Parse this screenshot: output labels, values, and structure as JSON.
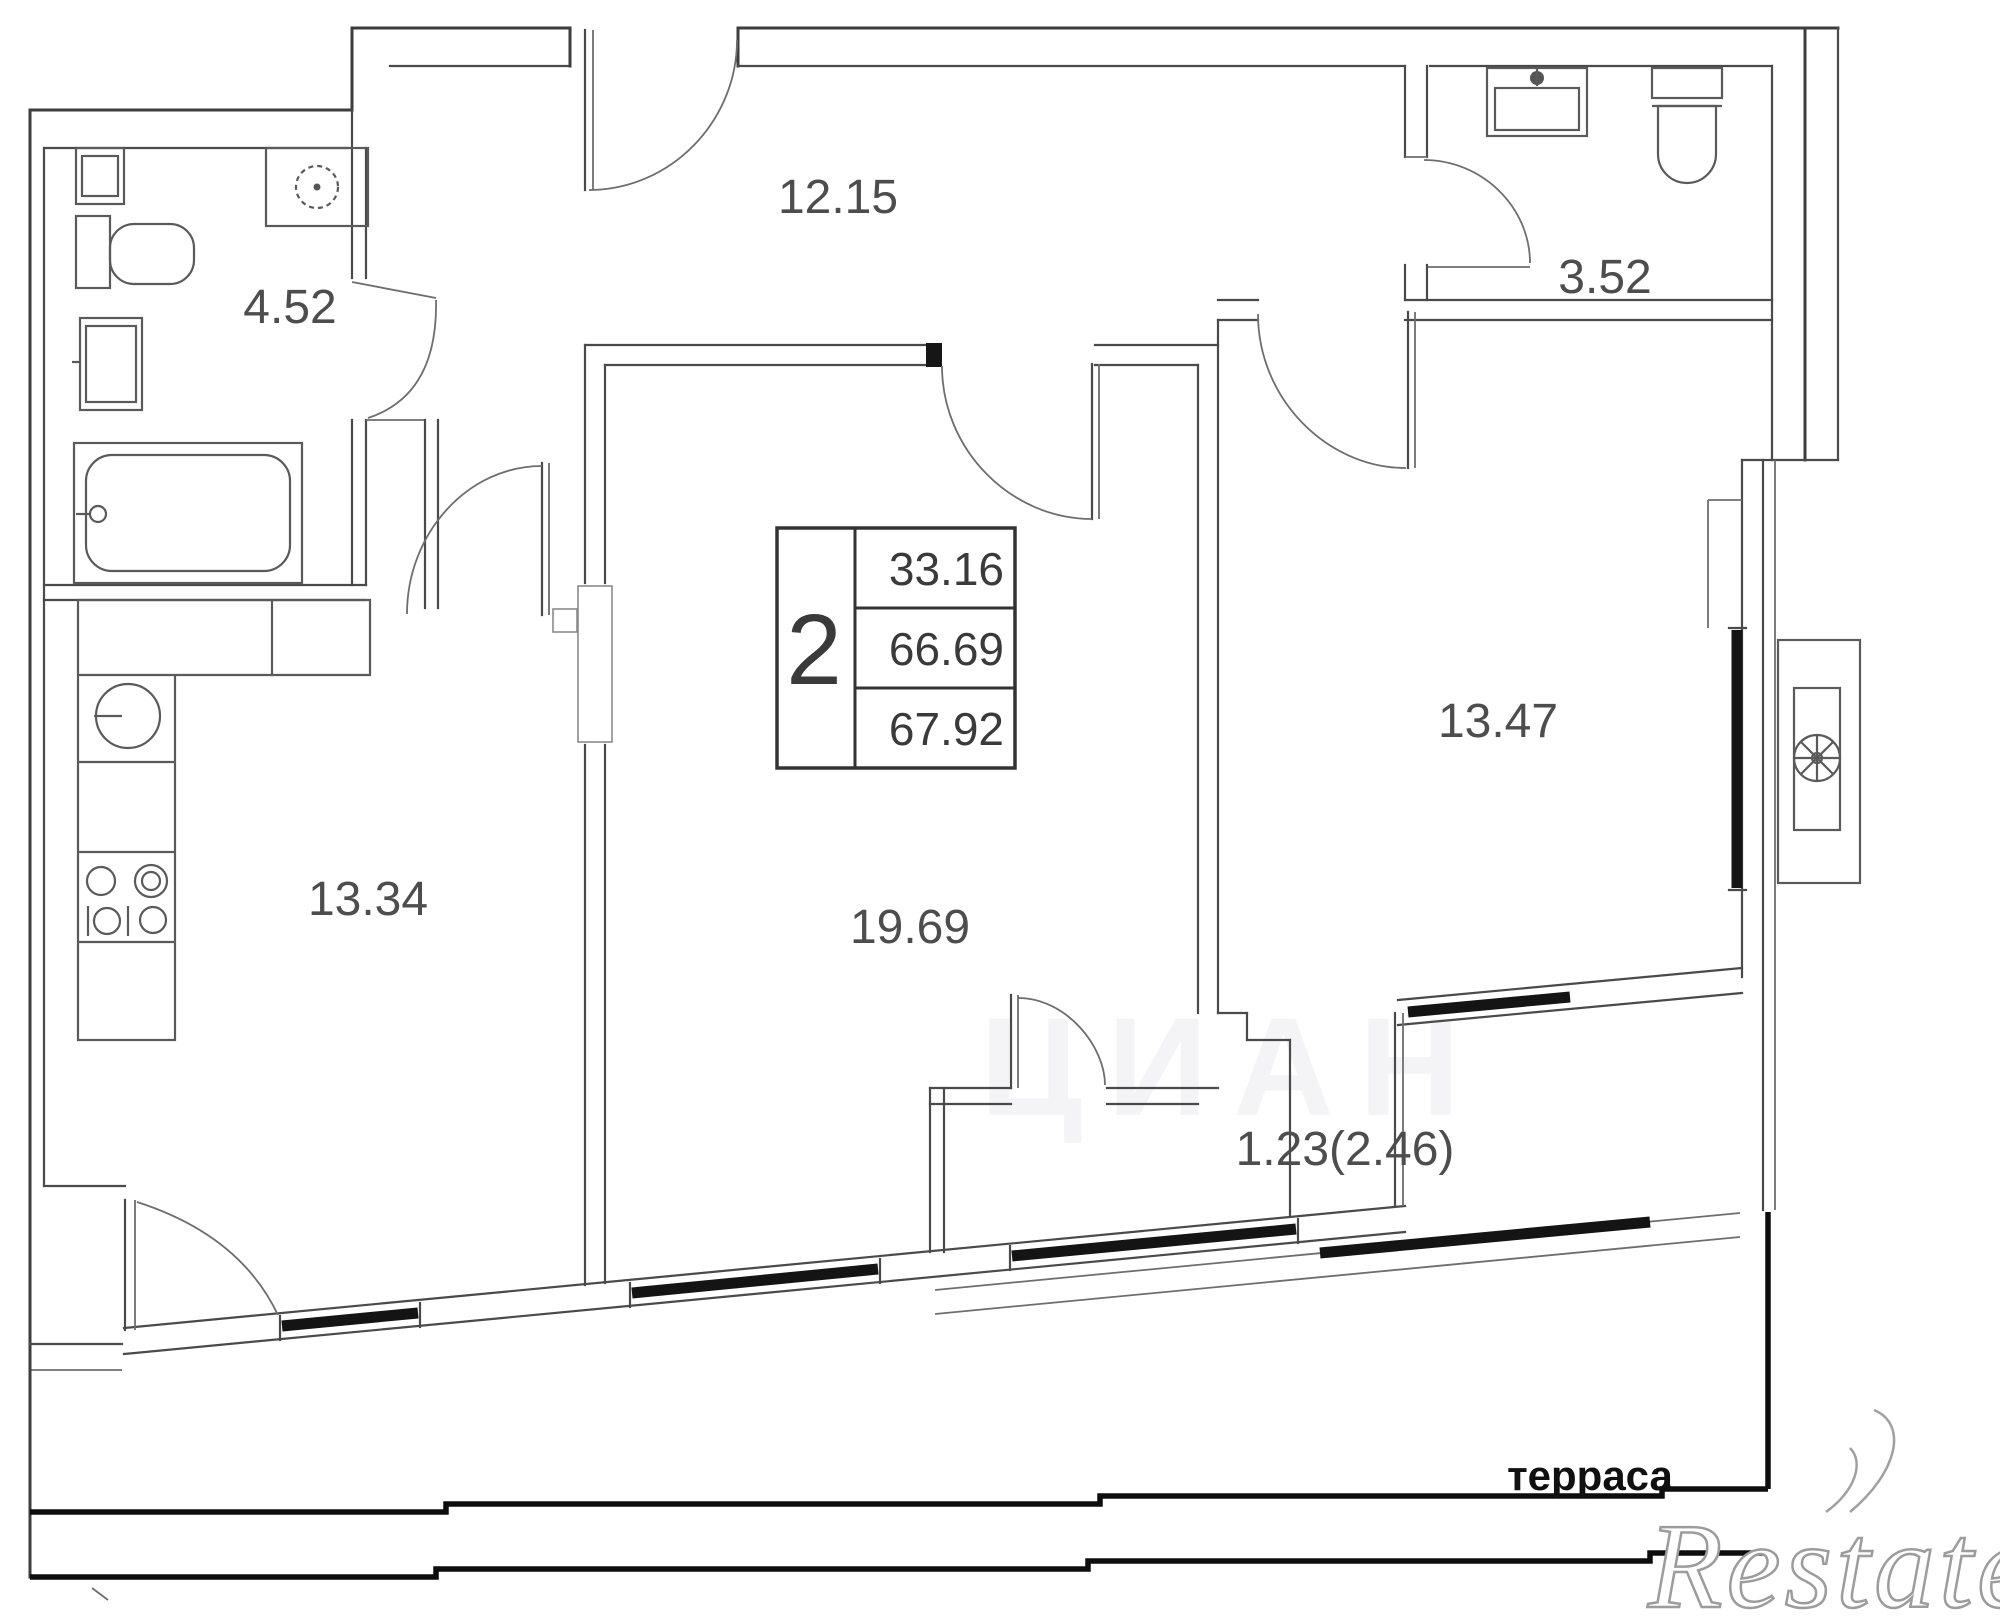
{
  "plan": {
    "info_table": {
      "rooms_count": "2",
      "living_area": "33.16",
      "area_without_balcony": "66.69",
      "total_area": "67.92"
    },
    "labels": {
      "hallway": "12.15",
      "wc": "3.52",
      "bathroom": "4.52",
      "bedroom": "13.47",
      "kitchen": "13.34",
      "living_room": "19.69",
      "balcony": "1.23(2.46)",
      "terrace": "терраса"
    },
    "watermarks": {
      "brand": "Restate",
      "ghost": "ЦИАН"
    }
  }
}
